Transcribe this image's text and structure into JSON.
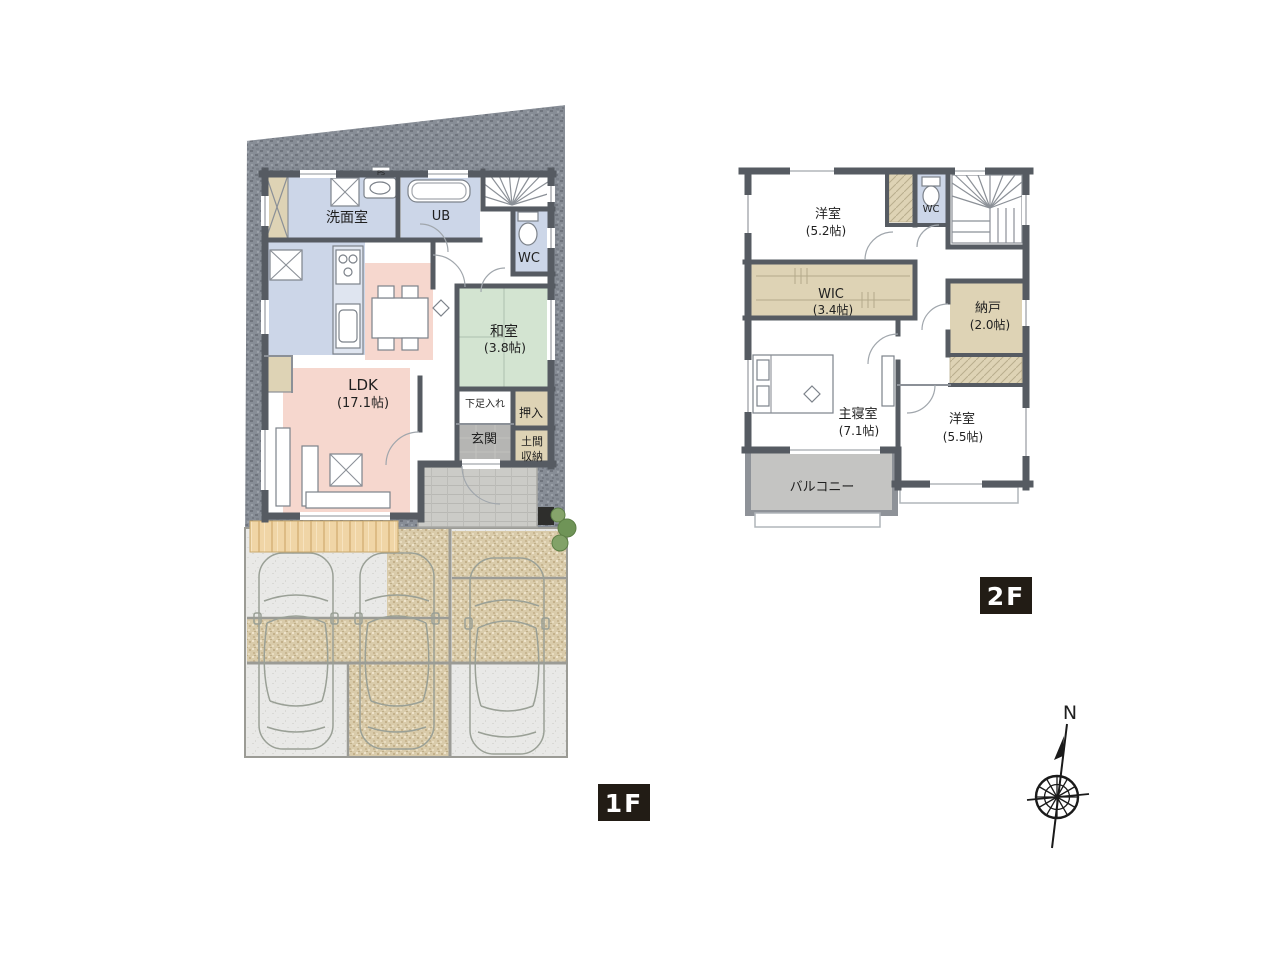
{
  "floor1": {
    "badge": "1F",
    "rooms": {
      "senmenshitsu": "洗面室",
      "ub": "UB",
      "ps": "PS",
      "wc": "WC",
      "washitsu": {
        "name": "和室",
        "size": "(3.8帖)"
      },
      "ldk": {
        "name": "LDK",
        "size": "(17.1帖)"
      },
      "getabako": "下足入れ",
      "oshiire": "押入",
      "genkan": "玄関",
      "doma": {
        "line1": "土間",
        "line2": "収納"
      }
    }
  },
  "floor2": {
    "badge": "2F",
    "rooms": {
      "yoshitsu_52": {
        "name": "洋室",
        "size": "(5.2帖)"
      },
      "wc": "WC",
      "wic": {
        "name": "WIC",
        "size": "(3.4帖)"
      },
      "nando": {
        "name": "納戸",
        "size": "(2.0帖)"
      },
      "shushinshitsu": {
        "name": "主寝室",
        "size": "(7.1帖)"
      },
      "yoshitsu_55": {
        "name": "洋室",
        "size": "(5.5帖)"
      },
      "balcony": "バルコニー"
    }
  },
  "compass": {
    "label": "N"
  },
  "colors": {
    "room_blue": "#ccd6e8",
    "tatami_green": "#d3e4d1",
    "ldk_pink": "#f6d7ce",
    "closet_beige": "#ded3b5",
    "genkan_gray": "#b5b5b3",
    "balcony_gray": "#c4c4c2",
    "counter_blue": "#dfe5f0",
    "wall_gray": "#565b62",
    "site_gray": "#878d96",
    "badge_bg": "#221c15"
  }
}
